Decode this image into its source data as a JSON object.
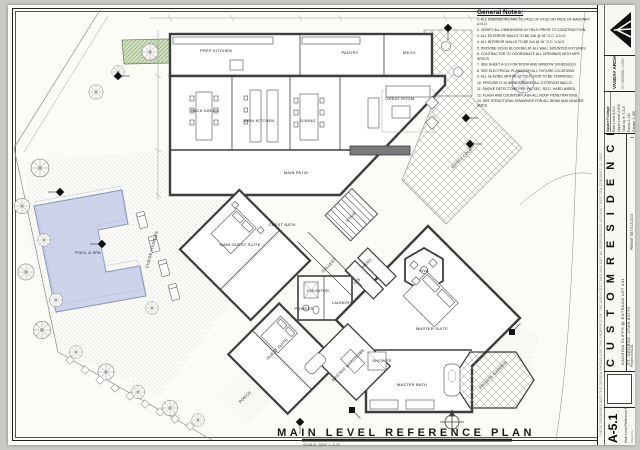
{
  "sheet": {
    "bottom_title": "MAIN LEVEL REFERENCE PLAN",
    "bottom_scale": "SCALE: 3/16\" = 1'-0\""
  },
  "general_notes": {
    "title": "General Notes:",
    "items": [
      "ALL DIMENSIONS ARE TO FACE OF STUD OR FACE OF MASONRY U.N.O.",
      "VERIFY ALL DIMENSIONS IN FIELD PRIOR TO CONSTRUCTION.",
      "ALL EXTERIOR WALLS TO BE 2x6 @ 16\" O.C. U.N.O.",
      "ALL INTERIOR WALLS TO BE 2x4 @ 16\" O.C. U.N.O.",
      "PROVIDE SOLID BLOCKING AT ALL WALL MOUNTED FIXTURES.",
      "CONTRACTOR TO COORDINATE ALL OPENINGS WITH MFR. SPECS.",
      "SEE SHEET A-9.1 FOR DOOR AND WINDOW SCHEDULES.",
      "SEE ELECTRICAL PLANS FOR ALL FIXTURE LOCATIONS.",
      "ALL GLAZING WITHIN 18\" OF FLOOR TO BE TEMPERED.",
      "PROVIDE R-19 INSULATION AT ALL EXTERIOR WALLS.",
      "SMOKE DETECTORS PER IRC SEC. R317, HARD WIRED.",
      "FLASH AND COUNTERFLASH ALL ROOF PENETRATIONS.",
      "SEE STRUCTURAL DRAWINGS FOR ALL BEAM AND HEADER SIZES."
    ]
  },
  "title_block": {
    "copyright": "THESE DRAWINGS AND THE DESIGN SHOWN ARE THE PROPERTY OF THE ARCHITECT AND MAY NOT BE REPRODUCED WITHOUT WRITTEN CONSENT.  © 2003",
    "firm_name": "VASDAY ARCHITECTS, PLLC",
    "firm_address": "ST. GEORGE  •  UTAH",
    "sqft_header": "Square Footage",
    "sqft_rows": [
      "Main Level   4,510",
      "Upper Level   2,805",
      "Total sq. ft.   7,315",
      "Patios   2,140",
      "Garage   1,185"
    ],
    "project_title": "C U S T O M   R E S I D E N C E",
    "project_location": "KACHINA CLIFFS @ ENTRADA LOT #41",
    "project_city": "ST. GEORGE, UTAH 84770",
    "project_number": "Project #   KC41",
    "issue": "PERMIT SET 8.15.2003",
    "sheet_number": "A-5.1",
    "sheet_title": "Main Level Reference Plan",
    "sheet_word": "Sheet No."
  },
  "plan": {
    "rooms": [
      {
        "label": "PREP KITCHEN",
        "x": 216,
        "y": 52
      },
      {
        "label": "PANTRY",
        "x": 350,
        "y": 54
      },
      {
        "label": "MECH.",
        "x": 410,
        "y": 54
      },
      {
        "label": "BACK DINING",
        "x": 205,
        "y": 112
      },
      {
        "label": "MAIN KITCHEN",
        "x": 259,
        "y": 122
      },
      {
        "label": "DINING",
        "x": 308,
        "y": 122
      },
      {
        "label": "GREAT ROOM",
        "x": 400,
        "y": 100
      },
      {
        "label": "MAIN PATIO",
        "x": 296,
        "y": 174
      },
      {
        "label": "ENTRY COURT",
        "x": 464,
        "y": 158,
        "r": -45
      },
      {
        "label": "STAIR",
        "x": 352,
        "y": 218,
        "r": -45
      },
      {
        "label": "GALLERY",
        "x": 330,
        "y": 266,
        "r": -45
      },
      {
        "label": "MAIN GUEST SUITE",
        "x": 240,
        "y": 246
      },
      {
        "label": "GUEST BATH",
        "x": 282,
        "y": 226
      },
      {
        "label": "ELEVATOR",
        "x": 318,
        "y": 292
      },
      {
        "label": "POWDER",
        "x": 304,
        "y": 310
      },
      {
        "label": "LAUNDRY",
        "x": 342,
        "y": 304
      },
      {
        "label": "HERS",
        "x": 368,
        "y": 264,
        "r": -45
      },
      {
        "label": "HIS",
        "x": 358,
        "y": 282,
        "r": -45
      },
      {
        "label": "KIVA",
        "x": 424,
        "y": 272
      },
      {
        "label": "MASTER SUITE",
        "x": 432,
        "y": 330
      },
      {
        "label": "MASTER BATH",
        "x": 412,
        "y": 386
      },
      {
        "label": "SHOWER",
        "x": 382,
        "y": 362
      },
      {
        "label": "MASTER WARDROBE",
        "x": 349,
        "y": 366,
        "r": -45
      },
      {
        "label": "PRIVATE GARDEN",
        "x": 494,
        "y": 376,
        "r": -45
      },
      {
        "label": "GUEST SUITE",
        "x": 278,
        "y": 350,
        "r": -45
      },
      {
        "label": "PORCH",
        "x": 246,
        "y": 398,
        "r": -45
      },
      {
        "label": "POOL & SPA",
        "x": 88,
        "y": 254
      },
      {
        "label": "CHAISE LOUNGES",
        "x": 153,
        "y": 250,
        "r": -75
      }
    ]
  }
}
